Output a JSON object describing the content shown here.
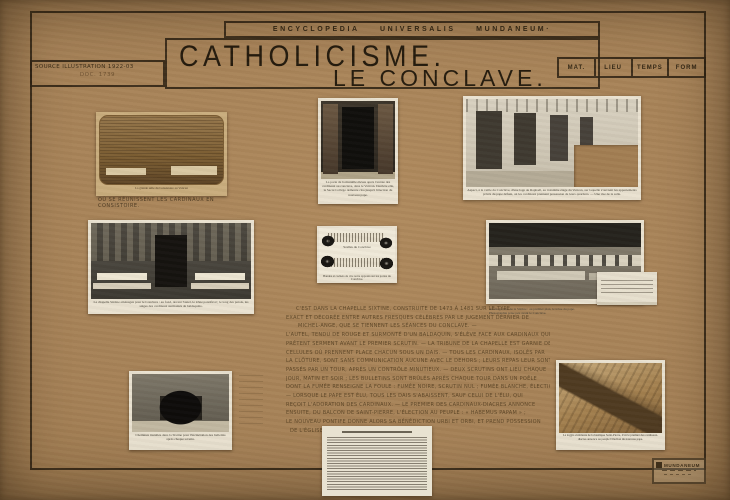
{
  "header": {
    "collection": "ENCYCLOPEDIA UNIVERSALIS MUNDANEUM·",
    "title_line1": "CATHOLICISME.",
    "title_line2": "LE CONCLAVE.",
    "source_line1": "Source Illustration 1922-03",
    "source_line2": "Doc. 1739",
    "facets": [
      "MAT.",
      "LIEU",
      "TEMPS",
      "FORM"
    ]
  },
  "photos": {
    "consistoire": {
      "print_caption": "La grande salle du Consistoire au Vatican",
      "hand_caption": "Où se réunissent les cardinaux en consistoire."
    },
    "porte_muree": {
      "caption": "La porte de la muraille élevée après l'entrée des cardinaux au conclave, dans le Vatican. Derrière elle, le Sacré Collège demeure clos jusqu'à l'élection du nouveau pape."
    },
    "loges_raphael": {
      "caption": "Aspect, à la veille du Conclave, d'une loge de Raphaël, au troisième étage du Vatican, sur laquelle s'ouvrent les appartements privés du pape défunt, où les cardinaux prennent possession de leurs quartiers. — Une vue de la salle."
    },
    "sixtine_trones": {
      "caption": "La chapelle Sixtine aménagée pour le Conclave : au fond, devant l'autel, le trône pontifical ; le long des parois, les sièges des cardinaux surmontés de baldaquins."
    },
    "scelles": {
      "center_label": "Scellés du Conclave",
      "caption": "Bandes et cachets de cire noire apposés sur les portes du Conclave."
    },
    "sixtine_cellules": {
      "caption": "Aménagement de la Sixtine : au premier plan, le trône du pape. Photographie prise peu avant le Conclave."
    },
    "poele": {
      "caption": "Cheminée installée dans la Sixtine pour l'incinération des bulletins après chaque scrutin."
    },
    "loggia_saint_pierre": {
      "caption": "La loggia extérieure de la basilique Saint-Pierre, d'où le premier des cardinaux-diacres annonce au peuple l'élection du nouveau pape."
    }
  },
  "note": {
    "lines": [
      "C'est dans la chapelle Sixtine, construite de 1473 à 1481 sur le type",
      "exact et décorée entre autres fresques célèbres par le Jugement dernier de",
      "Michel-Ange, que se tiennent les séances du conclave. —",
      "L'autel, tendu de rouge et surmonté d'un baldaquin, s'élève face aux cardinaux qui",
      "prêtent serment avant le premier scrutin. — La tribune de la chapelle est garnie de",
      "cellules où prennent place chacun sous un dais. — Tous les cardinaux, isolés par",
      "la clôture, sont sans communication aucune avec le dehors ; leurs repas leur sont",
      "passés par un tour, après un contrôle minutieux. — Deux scrutins ont lieu chaque",
      "jour, matin et soir ; les bulletins sont brûlés après chaque tour dans un poêle",
      "dont la fumée renseigne la foule : fumée noire, scrutin nul ; fumée blanche, élection.",
      "— Lorsque le pape est élu, tous les dais s'abaissent, sauf celui de l'élu, qui",
      "reçoit l'adoration des cardinaux. — Le premier des cardinaux-diacres annonce",
      "ensuite, du balcon de Saint-Pierre, l'élection au peuple : « Habemus papam » ;",
      "le nouveau pontife donne alors sa bénédiction urbi et orbi, et prend possession",
      "de l'Église. —"
    ]
  },
  "stamp": {
    "label": "MUNDANEUM"
  }
}
